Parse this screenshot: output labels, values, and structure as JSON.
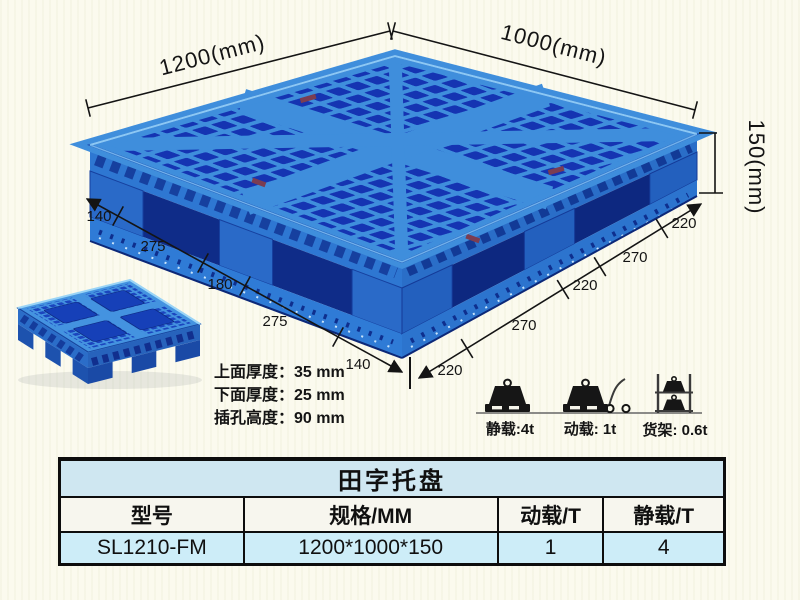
{
  "colors": {
    "pallet_blue": "#3F8EDC",
    "pallet_dark_blue": "#1534B2",
    "pallet_side_blue": "#2A6AC8",
    "table_title_bg": "#CFE7F1",
    "table_row_bg": "#CDEDF8",
    "background": "#FBFAEE"
  },
  "diagram": {
    "dim_top_left": "1200(mm)",
    "dim_top_right": "1000(mm)",
    "dim_height": "150(mm)",
    "left_chain": [
      "140",
      "275",
      "180",
      "275",
      "140"
    ],
    "right_chain": [
      "220",
      "270",
      "220",
      "270",
      "220"
    ],
    "thickness_notes": [
      "上面厚度：35 mm",
      "下面厚度：25 mm",
      "插孔高度：90 mm"
    ]
  },
  "loads": {
    "static_label": "静载:4t",
    "dynamic_label": "动载: 1t",
    "rack_label": "货架: 0.6t",
    "icons": {
      "static": "weight-on-pallet-icon",
      "dynamic": "weight-trolley-icon",
      "rack": "rack-shelf-icon"
    }
  },
  "table": {
    "title": "田字托盘",
    "headers": [
      "型号",
      "规格/MM",
      "动载/T",
      "静载/T"
    ],
    "row": [
      "SL1210-FM",
      "1200*1000*150",
      "1",
      "4"
    ]
  }
}
